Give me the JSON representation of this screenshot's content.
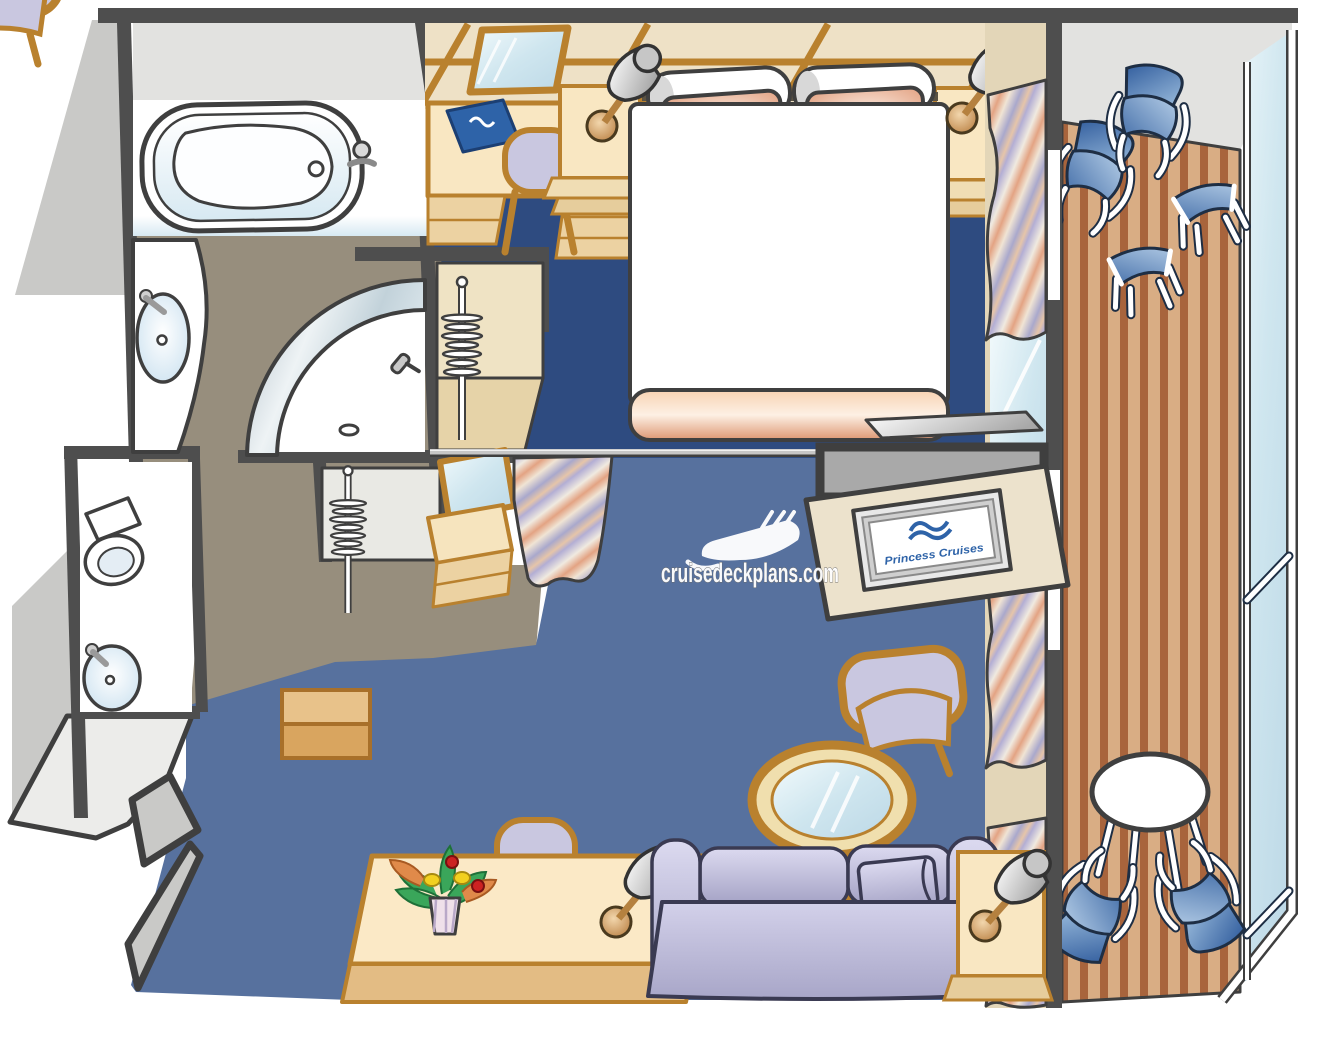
{
  "image": {
    "type": "floor-plan-illustration",
    "subject": "Cruise ship suite stateroom with private balcony",
    "style": "isometric color cartoon floor plan"
  },
  "watermark": {
    "text": "cruisedeckplans.com",
    "icon": "cruise-ship-icon",
    "color": "#ffffff"
  },
  "tv_screen": {
    "brand_text": "Princess Cruises",
    "logo": "princess-seawitch-wave-logo",
    "text_color": "#2e63a8"
  },
  "palette": {
    "wall": "#4e4e4e",
    "wall_gray": "#c9c9c7",
    "wall_light": "#e2e2e0",
    "pale": "#ececea",
    "floor_taupe": "#978e7d",
    "carpet_bedroom": "#2e4b80",
    "carpet_lounge": "#57719e",
    "wood_light": "#f9e7c4",
    "wood_mid": "#ecd2a2",
    "wood_dark": "#dba55f",
    "wood_outline": "#b9812e",
    "deck_tan": "#d9ad84",
    "deck_brown": "#a8643c",
    "chair_blue": "#35609f",
    "lavender": "#c9c7e0",
    "peach": "#e29b78",
    "glass": "#cde3ee",
    "logo_blue": "#2e63a8",
    "white": "#ffffff"
  },
  "rooms": {
    "bathroom": {
      "label": "Master bathroom",
      "fixtures": [
        "bathtub",
        "vanity-sink",
        "curved-glass-shower",
        "shower-head",
        "drain"
      ]
    },
    "water_closet": {
      "label": "Second bathroom",
      "fixtures": [
        "toilet",
        "sink",
        "counter"
      ]
    },
    "wardrobes": {
      "label": "Wardrobes",
      "fixtures": [
        "clothes-rail-with-hangers",
        "clothes-rail-with-hangers",
        "dresser-with-mirror"
      ]
    },
    "bedroom": {
      "label": "Bedroom",
      "furniture": [
        "queen-bed",
        "bolster-pillow",
        "bolster-pillow",
        "peach-accent-pillow",
        "peach-accent-pillow",
        "foot-blanket",
        "nightstand-left",
        "nightstand-right",
        "table-lamp",
        "table-lamp",
        "vanity-desk",
        "desk-mirror",
        "guest-directory-book",
        "desk-chair",
        "window-curtains"
      ]
    },
    "lounge": {
      "label": "Sitting area",
      "furniture": [
        "sofa",
        "sofa-pillow",
        "wicker-armchair",
        "wicker-armchair",
        "round-glass-coffee-table",
        "writing-desk",
        "desk-chair",
        "flower-vase",
        "side-table",
        "side-table",
        "table-lamp",
        "table-lamp",
        "tv-cabinet",
        "flat-screen-tv",
        "privacy-curtain-and-rod",
        "entry-bench"
      ]
    },
    "balcony": {
      "label": "Private balcony",
      "furniture": [
        "reclining-chair",
        "reclining-chair",
        "footstool",
        "footstool",
        "round-table",
        "balcony-chair",
        "balcony-chair",
        "glass-balustrade",
        "teak-decking"
      ]
    }
  }
}
